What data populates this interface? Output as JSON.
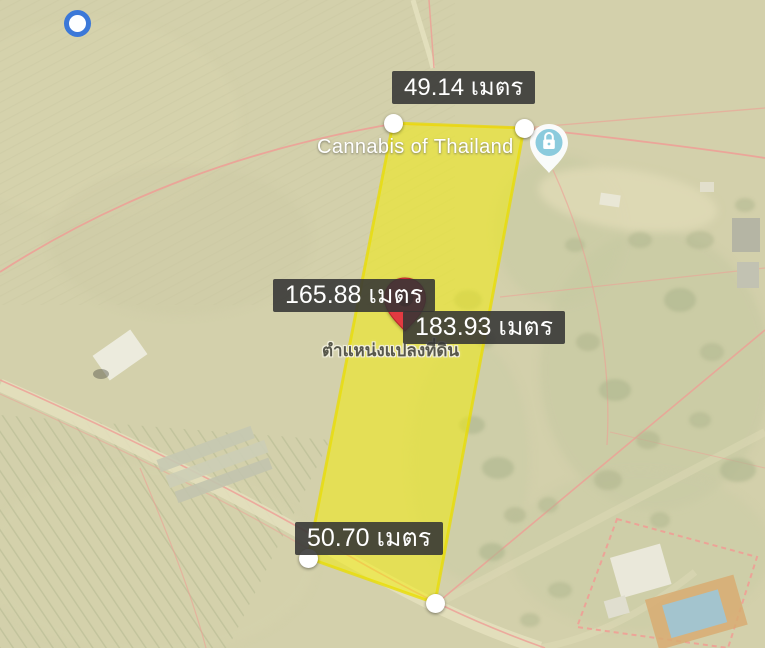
{
  "map": {
    "place_label": "Cannabis of Thailand",
    "marker_caption": "ตำแหน่งแปลงที่ดิน"
  },
  "measurements": {
    "top": "49.14 เมตร",
    "left": "165.88 เมตร",
    "right": "183.93 เมตร",
    "bottom": "50.70 เมตร"
  },
  "icons": {
    "locate_circle": "blue-ring-circle-icon",
    "place_pin": "lock-place-pin-icon",
    "marker": "red-map-pin-icon",
    "vertex_handle": "white-vertex-handle-icon"
  },
  "colors": {
    "map_base": "#D3D0AB",
    "parcel_fill": "#F4EE08",
    "parcel_stroke": "#E8DC00",
    "cadastral_line": "#EF9E95",
    "road": "#E3DFBC",
    "measurement_label_bg": "#343434",
    "measurement_label_text": "#FFFFFF",
    "marker_red": "#E23A41",
    "marker_hole": "#8C1E24",
    "locate_ring_blue": "#3B78D8",
    "place_pin_blue": "#8BCBDD"
  }
}
